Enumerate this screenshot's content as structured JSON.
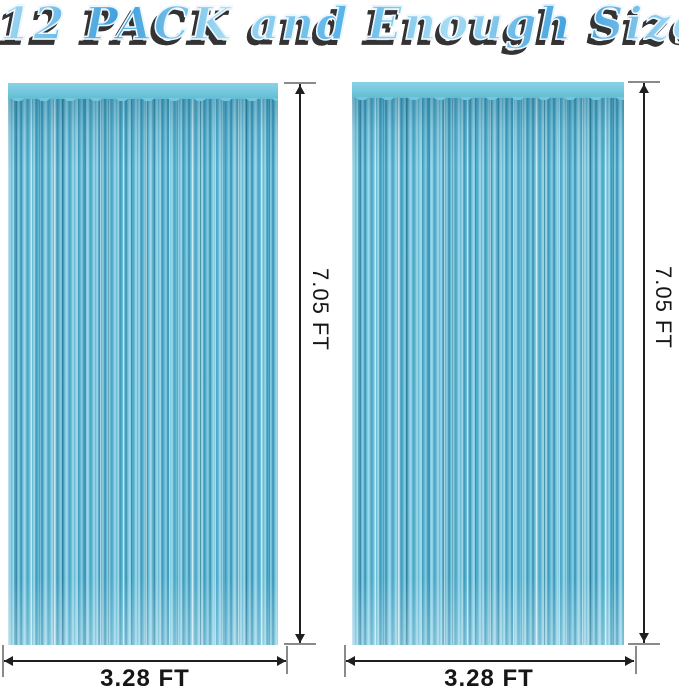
{
  "title": "12 PACK and Enough Size",
  "curtains": [
    {
      "id": "left",
      "height_label": "7.05 FT",
      "width_label": "3.28 FT"
    },
    {
      "id": "right",
      "height_label": "7.05 FT",
      "width_label": "3.28 FT"
    }
  ],
  "colors": {
    "bg": "#ffffff",
    "line": "#1f1f1f",
    "cap": "#8a8a8a",
    "label": "#161616",
    "title_main": "#5ab4e8",
    "title_light": "#a6dcf4",
    "title_dark": "#3f9fdc",
    "title_shadow": "#333333",
    "header_blue": "#74c8de",
    "curtain_light": "#a8dcee",
    "curtain_mid": "#5ab3d0",
    "curtain_dark": "#2f8cb0"
  }
}
